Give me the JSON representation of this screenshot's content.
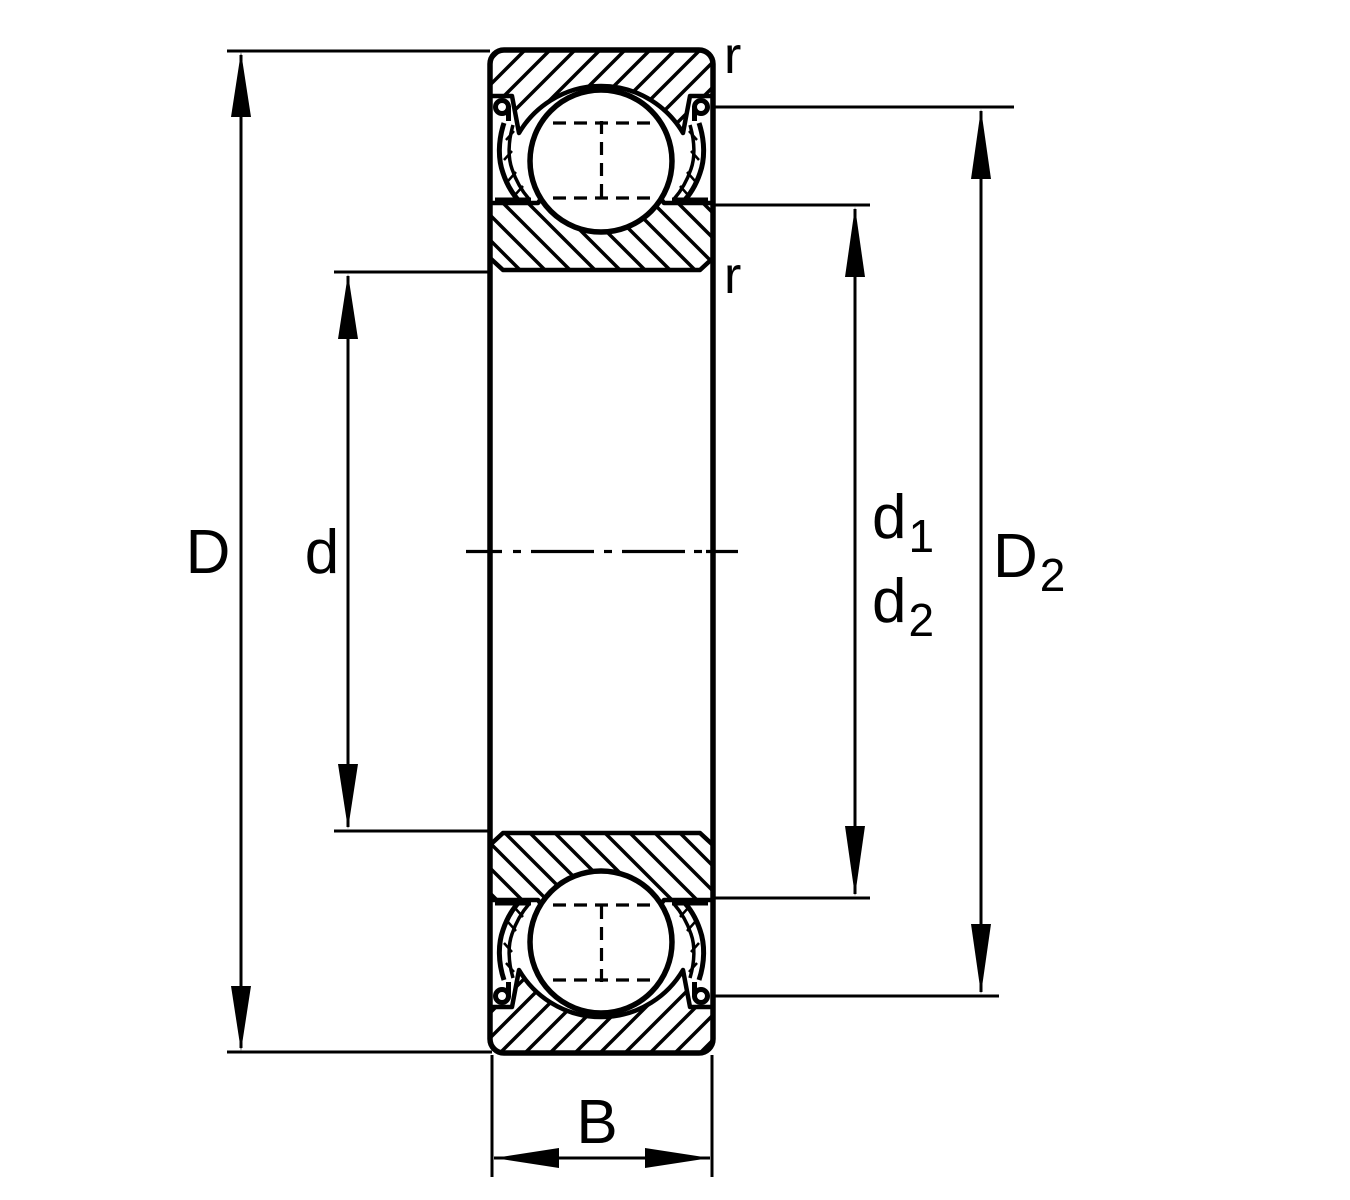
{
  "drawing": {
    "background": "#ffffff",
    "line_color": "#000000",
    "labels": {
      "D": "D",
      "d": "d",
      "d1": {
        "base": "d",
        "sub": "1"
      },
      "d2": {
        "base": "d",
        "sub": "2"
      },
      "D2": {
        "base": "D",
        "sub": "2"
      },
      "B": "B",
      "r_outer_ring": "r",
      "r_inner_ring": "r"
    }
  }
}
